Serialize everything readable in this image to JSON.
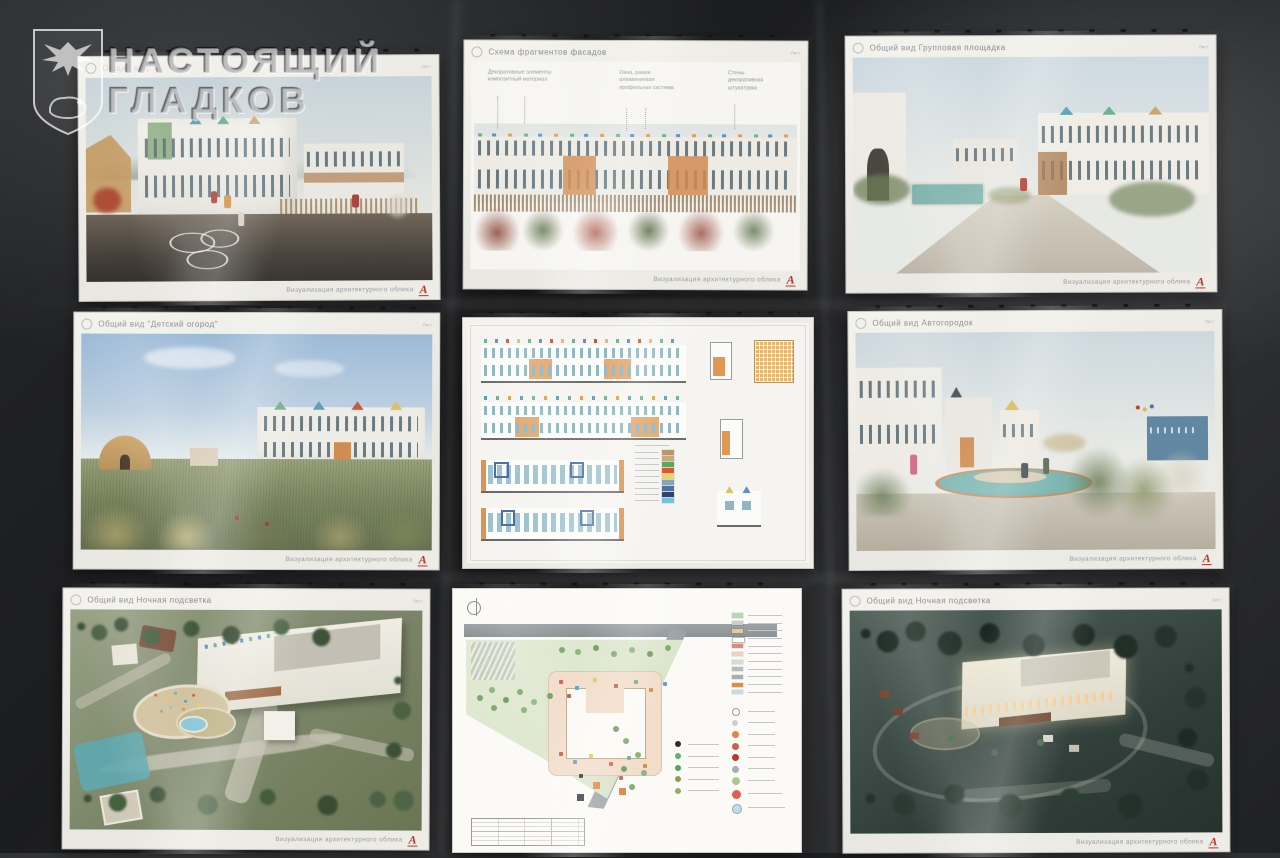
{
  "watermark": {
    "line1": "НАСТОЯЩИЙ",
    "line2": "ГЛАДКОВ",
    "emblem": "belgorod-region-coat-of-arms"
  },
  "common": {
    "footer": "Визуализация архитектурного облика",
    "logo_letter": "А",
    "sheet_label": "Лист"
  },
  "sheets": [
    {
      "id": "street-view",
      "title": "Общий вид"
    },
    {
      "id": "facade-fragments",
      "title": "Схема фрагментов фасадов",
      "annotations": [
        "Декоративные элементы\nкомпозитный материал",
        "Окна, рамки\nалюминиевая\nпрофильная система",
        "Стены\nдекоративная\nштукатурка"
      ]
    },
    {
      "id": "group-playground",
      "title": "Общий вид Групповая площадка"
    },
    {
      "id": "children-garden",
      "title": "Общий вид \"Детский огород\""
    },
    {
      "id": "facade-elevations",
      "title": ""
    },
    {
      "id": "auto-town",
      "title": "Общий вид Автогородок"
    },
    {
      "id": "night-lighting-aerial-day",
      "title": "Общий вид Ночная подсветка"
    },
    {
      "id": "site-plan",
      "title": ""
    },
    {
      "id": "night-lighting-aerial",
      "title": "Общий вид Ночная подсветка"
    }
  ],
  "colors": {
    "logo_red": "#b5342a",
    "paper": "#f2f0ea",
    "fabric": "#202123"
  }
}
